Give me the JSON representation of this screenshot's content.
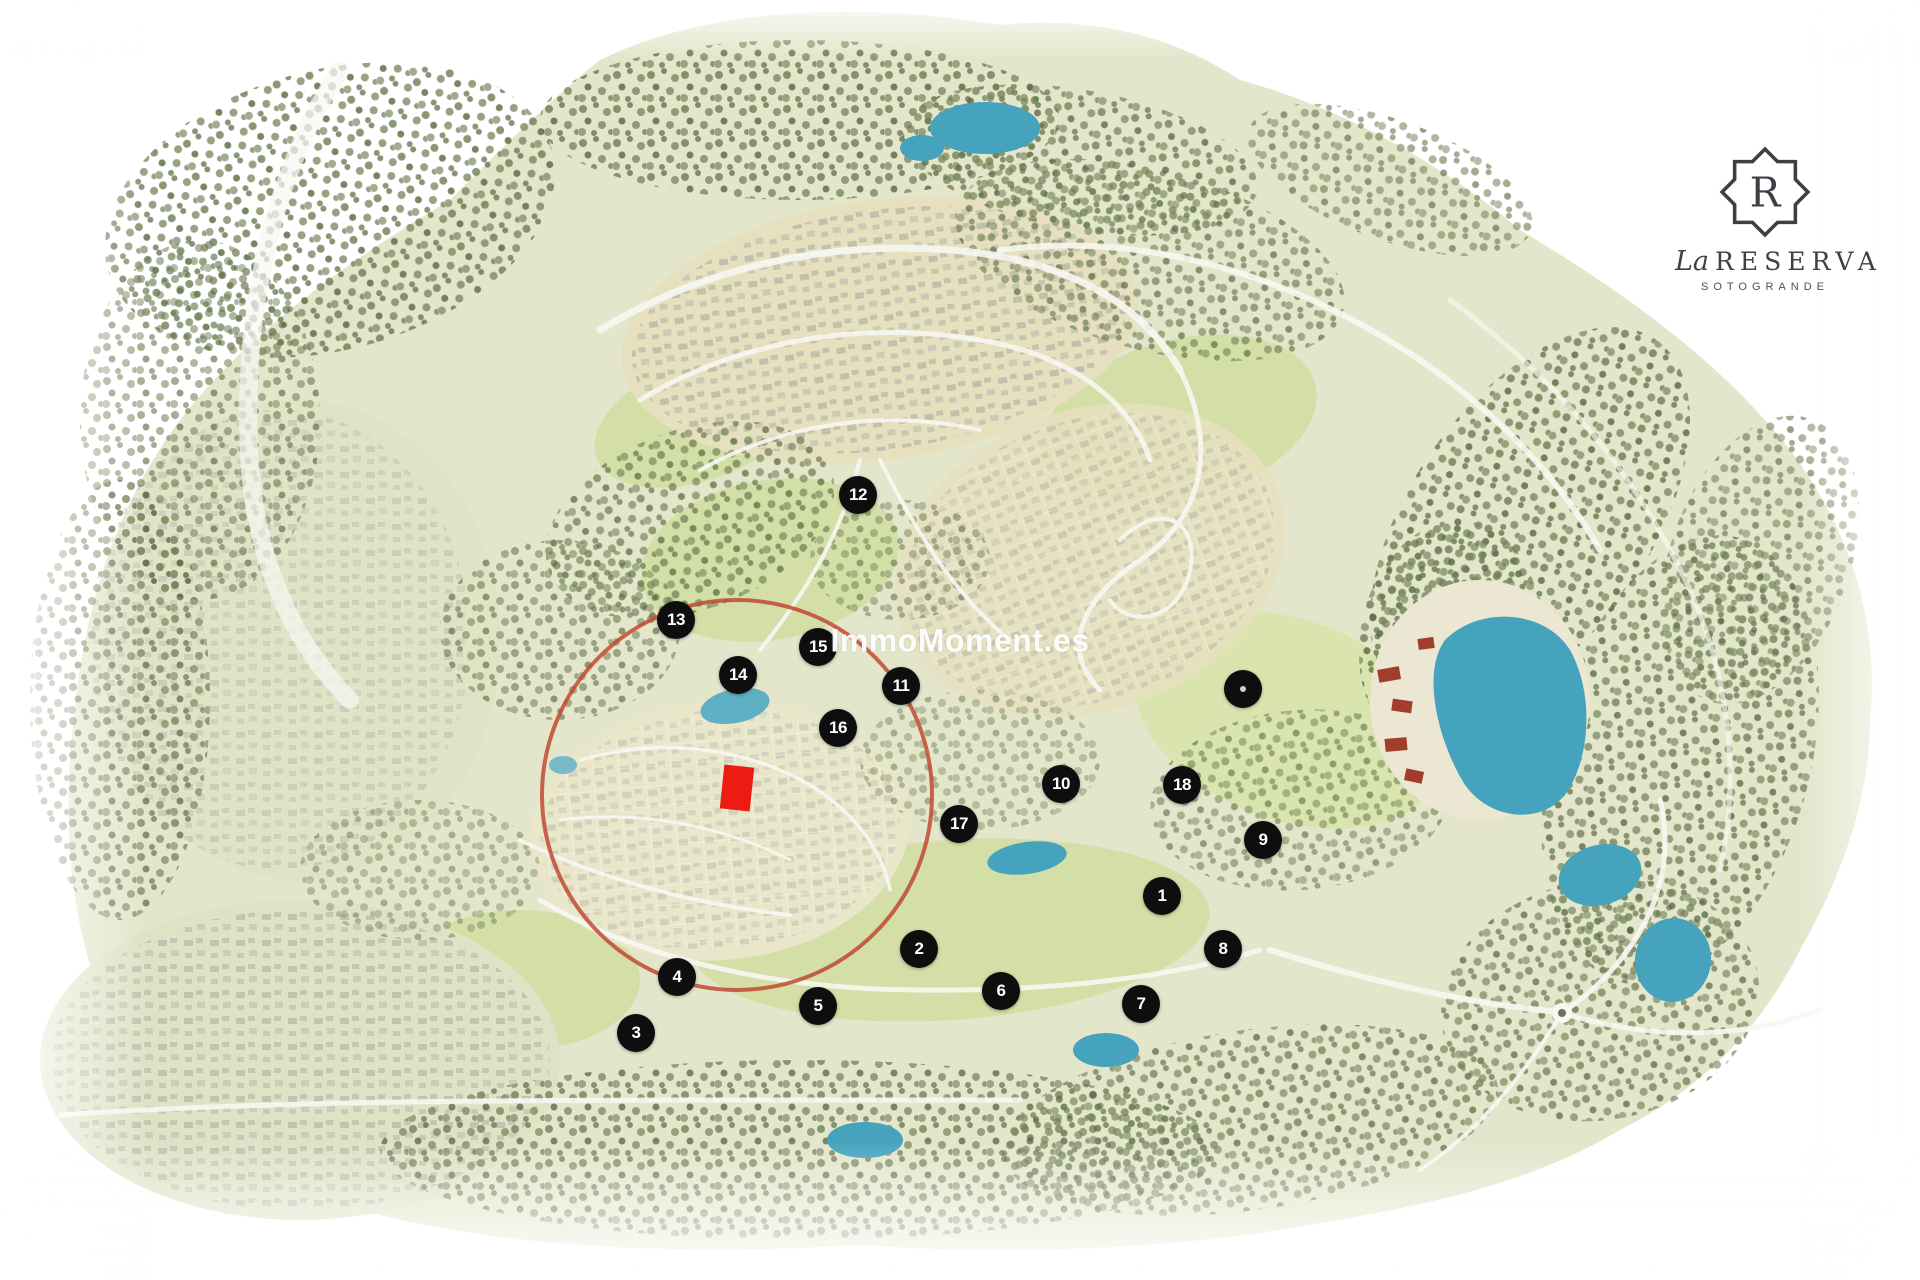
{
  "map": {
    "watermark": "ImmoMoment.es",
    "markers": [
      {
        "label": "1",
        "x": 1162,
        "y": 896
      },
      {
        "label": "2",
        "x": 919,
        "y": 949
      },
      {
        "label": "3",
        "x": 636,
        "y": 1033
      },
      {
        "label": "4",
        "x": 677,
        "y": 977
      },
      {
        "label": "5",
        "x": 818,
        "y": 1006
      },
      {
        "label": "6",
        "x": 1001,
        "y": 991
      },
      {
        "label": "7",
        "x": 1141,
        "y": 1004
      },
      {
        "label": "8",
        "x": 1223,
        "y": 949
      },
      {
        "label": "9",
        "x": 1263,
        "y": 840
      },
      {
        "label": "10",
        "x": 1061,
        "y": 784
      },
      {
        "label": "11",
        "x": 901,
        "y": 686
      },
      {
        "label": "12",
        "x": 858,
        "y": 495
      },
      {
        "label": "13",
        "x": 676,
        "y": 620
      },
      {
        "label": "14",
        "x": 738,
        "y": 675
      },
      {
        "label": "15",
        "x": 818,
        "y": 647
      },
      {
        "label": "16",
        "x": 838,
        "y": 728
      },
      {
        "label": "17",
        "x": 959,
        "y": 824
      },
      {
        "label": "18",
        "x": 1182,
        "y": 785
      },
      {
        "label": "",
        "x": 1243,
        "y": 689
      }
    ],
    "highlight": {
      "circle": {
        "cx": 737,
        "cy": 795,
        "r": 195
      },
      "plot": {
        "x": 722,
        "y": 766,
        "width": 30,
        "height": 44,
        "rotate": 6
      }
    }
  },
  "logo": {
    "initial": "R",
    "name_script": "La",
    "name": "RESERVA",
    "subtitle": "SOTOGRANDE"
  },
  "colors": {
    "marker": "#0e0e0e",
    "marker-text": "#ffffff",
    "plot-red": "#ee1b15",
    "circle-red": "#bf4a32",
    "water": "#45a3bd",
    "land": "#e3e6cb",
    "land-open": "#d3dfa6",
    "village": "#e6e0bf",
    "trees1": "#6f7e53",
    "trees2": "#57693f",
    "road": "#f8f8f2",
    "sand": "#ece7d2",
    "roof-red": "#a03d2c",
    "logo-ink": "#3c4147"
  }
}
